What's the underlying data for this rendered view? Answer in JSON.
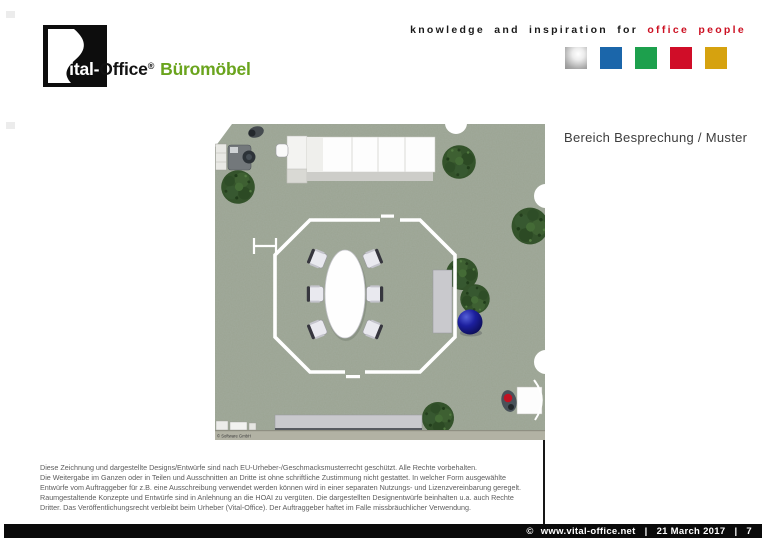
{
  "header": {
    "tagline_black": "knowledge and inspiration for",
    "tagline_red": "office people",
    "palette": {
      "silver": "#b5b5b5",
      "blue": "#1b66aa",
      "green": "#1da04d",
      "red": "#d00d28",
      "gold": "#d6a20f"
    }
  },
  "logo": {
    "brand_prefix": "Vital-",
    "brand_suffix": "Office",
    "registered_mark": "®",
    "product": "Büromöbel",
    "brand_green": "#6aa41d"
  },
  "main": {
    "heading": "Bereich Besprechung / Muster",
    "plan_watermark": "© Software GmbH",
    "plan_colors": {
      "carpet": "#9aa392",
      "tree": "#34532b",
      "wall": "#ffffff",
      "sideboard": "#c9c9cd",
      "sphere": "#1c1f9e"
    }
  },
  "disclaimer": {
    "lines": [
      "Diese Zeichnung und dargestellte Designs/Entwürfe sind nach EU-Urheber-/Geschmacksmusterrecht geschützt. Alle Rechte vorbehalten.",
      "Die Weitergabe im Ganzen oder in Teilen und Ausschnitten an Dritte ist ohne schriftliche Zustimmung nicht gestattet. In welcher Form ausgewählte",
      "Entwürfe vom Auftraggeber für z.B. eine Ausschreibung verwendet werden können wird in einer separaten Nutzungs- und Lizenzvereinbarung geregelt.",
      "Raumgestaltende Konzepte und Entwürfe sind in Anlehnung an die HOAI zu vergüten. Die dargestellten Designentwürfe beinhalten u.a. auch Rechte",
      "Dritter. Das Veröffentlichungsrecht verbleibt beim Urheber (Vital-Office). Der Auftraggeber haftet im Falle missbräuchlicher Verwendung."
    ]
  },
  "footer": {
    "copyright_symbol": "©",
    "website": "www.vital-office.net",
    "separator": "|",
    "date": "21 March 2017",
    "page_number": "7"
  }
}
